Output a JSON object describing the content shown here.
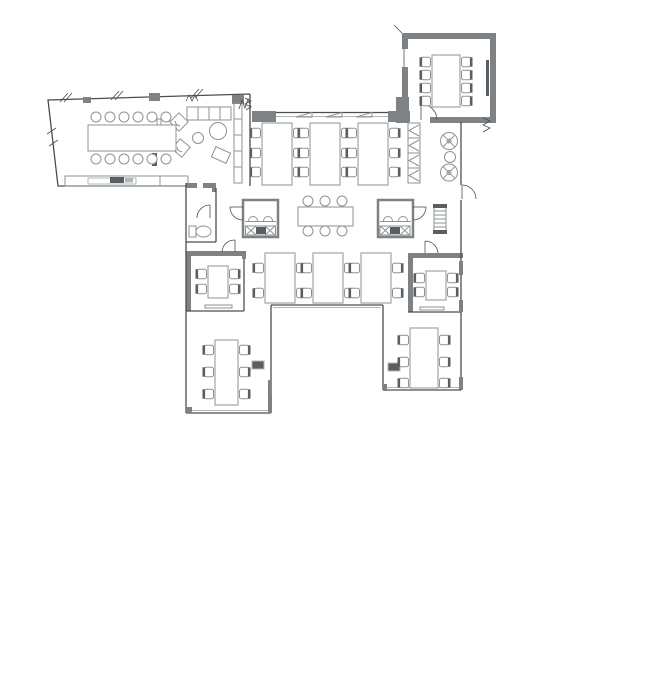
{
  "meta": {
    "type": "architectural-floor-plan",
    "subject": "office-floor-plan",
    "visible_text": ""
  },
  "colors": {
    "background": "#ffffff",
    "wall_line": "#4a4e51",
    "wall_fill": "#7e8285",
    "furniture_line": "#8d9396",
    "furniture_light": "#b2b7ba",
    "equipment_dark": "#5a5e61"
  },
  "rooms": [
    {
      "id": "conference-room-left",
      "symbols": [
        "conference-table-12-seats",
        "media-screen",
        "sofa-4-seat",
        "armchair",
        "armchair",
        "round-table",
        "side-table",
        "ottoman",
        "shelf-unit",
        "credenza"
      ]
    },
    {
      "id": "meeting-room-top-right",
      "symbols": [
        "table-8-seats",
        "wall-screen",
        "door"
      ]
    },
    {
      "id": "open-office",
      "symbols": [
        "desk-bank-6-seats",
        "desk-bank-6-seats",
        "desk-bank-6-seats",
        "desk-bank-4-seats",
        "desk-bank-4-seats",
        "desk-bank-4-seats",
        "breakout-table-6-seats",
        "kitchen-pod",
        "kitchen-pod",
        "locker-column",
        "swivel-chair",
        "swivel-chair",
        "side-table",
        "radiator"
      ]
    },
    {
      "id": "meeting-room-small-left",
      "symbols": [
        "table-4-seats",
        "door",
        "credenza"
      ]
    },
    {
      "id": "meeting-room-small-right",
      "symbols": [
        "table-4-seats",
        "door",
        "credenza"
      ]
    },
    {
      "id": "wc-vestibule",
      "symbols": [
        "toilet",
        "door",
        "door"
      ]
    },
    {
      "id": "wing-bottom-left",
      "symbols": [
        "desk-bank-6-seats",
        "printer"
      ]
    },
    {
      "id": "wing-bottom-right",
      "symbols": [
        "desk-bank-6-seats",
        "printer"
      ]
    }
  ],
  "furniture": {
    "desk_banks": [
      {
        "name": "open-office-desk-bank-1",
        "x": 262,
        "y": 123,
        "w": 30,
        "h": 62,
        "chair_rows": [
          133,
          153,
          172
        ]
      },
      {
        "name": "open-office-desk-bank-2",
        "x": 310,
        "y": 123,
        "w": 30,
        "h": 62,
        "chair_rows": [
          133,
          153,
          172
        ]
      },
      {
        "name": "open-office-desk-bank-3",
        "x": 358,
        "y": 123,
        "w": 30,
        "h": 62,
        "chair_rows": [
          133,
          153,
          172
        ]
      },
      {
        "name": "open-office-desk-bank-4",
        "x": 265,
        "y": 253,
        "w": 30,
        "h": 50,
        "chair_rows": [
          268,
          293
        ]
      },
      {
        "name": "open-office-desk-bank-5",
        "x": 313,
        "y": 253,
        "w": 30,
        "h": 50,
        "chair_rows": [
          268,
          293
        ]
      },
      {
        "name": "open-office-desk-bank-6",
        "x": 361,
        "y": 253,
        "w": 30,
        "h": 50,
        "chair_rows": [
          268,
          293
        ]
      },
      {
        "name": "wing-left-desk-bank",
        "x": 215,
        "y": 340,
        "w": 23,
        "h": 65,
        "chair_rows": [
          350,
          372,
          394
        ]
      },
      {
        "name": "wing-right-desk-bank",
        "x": 410,
        "y": 328,
        "w": 28,
        "h": 60,
        "chair_rows": [
          340,
          362,
          383
        ]
      },
      {
        "name": "meeting-left-table",
        "x": 208,
        "y": 266,
        "w": 20,
        "h": 32,
        "chair_rows": [
          274,
          289
        ]
      },
      {
        "name": "meeting-right-table",
        "x": 426,
        "y": 271,
        "w": 20,
        "h": 29,
        "chair_rows": [
          278,
          292
        ]
      },
      {
        "name": "meeting-topright-table",
        "x": 432,
        "y": 55,
        "w": 28,
        "h": 52,
        "chair_rows": [
          62,
          75,
          88,
          101
        ]
      }
    ],
    "round_chair_tables": [
      {
        "name": "conference-table",
        "x": 88,
        "y": 125,
        "w": 88,
        "h": 26,
        "chair_cols": [
          96,
          110,
          124,
          138,
          152,
          166
        ],
        "top_y": 117,
        "bottom_y": 159,
        "r": 5
      },
      {
        "name": "breakout-table",
        "x": 298,
        "y": 207,
        "w": 55,
        "h": 19,
        "chair_cols": [
          308,
          325,
          342
        ],
        "top_y": 201,
        "bottom_y": 231,
        "r": 5
      }
    ]
  }
}
